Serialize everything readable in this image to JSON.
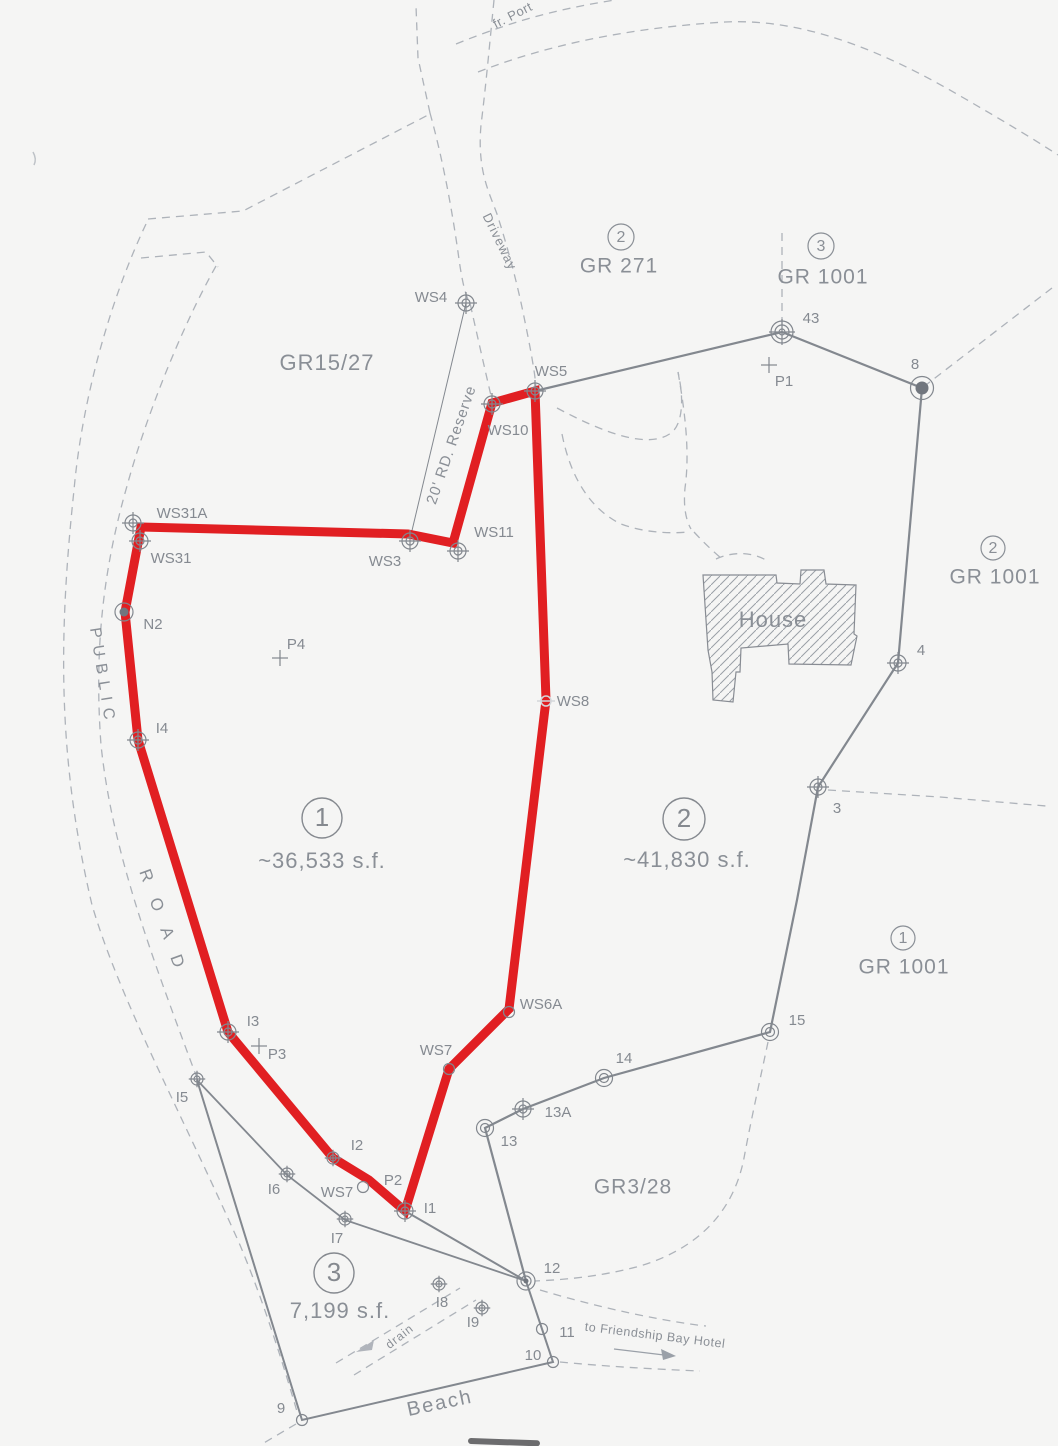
{
  "map": {
    "grant_labels": [
      {
        "text": "GR15/27",
        "x": 327,
        "y": 364,
        "size": 22
      },
      {
        "text": "GR 271",
        "x": 619,
        "y": 267,
        "size": 21,
        "badge": "2",
        "bx": 621,
        "by": 237,
        "br": 13
      },
      {
        "text": "GR 1001",
        "x": 823,
        "y": 278,
        "size": 21,
        "badge": "3",
        "bx": 821,
        "by": 246,
        "br": 13
      },
      {
        "text": "GR 1001",
        "x": 995,
        "y": 578,
        "size": 21,
        "badge": "2",
        "bx": 993,
        "by": 548,
        "br": 12
      },
      {
        "text": "GR 1001",
        "x": 904,
        "y": 968,
        "size": 21,
        "badge": "1",
        "bx": 903,
        "by": 938,
        "br": 12
      },
      {
        "text": "GR3/28",
        "x": 633,
        "y": 1188,
        "size": 21
      }
    ],
    "parcels": [
      {
        "number": "1",
        "area": "~36,533 s.f.",
        "cx": 322,
        "cy": 818,
        "r": 20,
        "ax": 322,
        "ay": 862
      },
      {
        "number": "2",
        "area": "~41,830 s.f.",
        "cx": 684,
        "cy": 819,
        "r": 21,
        "ax": 687,
        "ay": 861
      },
      {
        "number": "3",
        "area": "7,199 s.f.",
        "cx": 334,
        "cy": 1273,
        "r": 20,
        "ax": 340,
        "ay": 1312
      }
    ],
    "feature_labels": [
      {
        "id": "house-label",
        "text": "House",
        "x": 773,
        "y": 621,
        "size": 22,
        "rot": 0,
        "spacing": 1
      },
      {
        "id": "beach-label",
        "text": "Beach",
        "x": 440,
        "y": 1404,
        "size": 20,
        "rot": -12,
        "spacing": 2
      },
      {
        "id": "drain-label",
        "text": "drain",
        "x": 400,
        "y": 1337,
        "size": 12,
        "rot": -38,
        "spacing": 1
      },
      {
        "id": "hotel-route-label",
        "text": "to Friendship Bay Hotel",
        "x": 655,
        "y": 1336,
        "size": 12.5,
        "rot": 7,
        "spacing": 0.5
      },
      {
        "id": "from-port-label",
        "text": "fr. Port",
        "x": 513,
        "y": 16,
        "size": 13,
        "rot": -27,
        "spacing": 0.5
      },
      {
        "id": "road-reserve-label",
        "text": "20' RD. Reserve",
        "x": 452,
        "y": 445,
        "size": 15,
        "rot": -71,
        "spacing": 1
      },
      {
        "id": "driveway-label",
        "text": "Driveway",
        "x": 499,
        "y": 242,
        "size": 13,
        "rot": 64,
        "spacing": 1
      },
      {
        "id": "public-road-label-1",
        "text": "PUBLIC",
        "x": 102,
        "y": 677,
        "size": 16,
        "rot": 81,
        "spacing": 7
      },
      {
        "id": "public-road-label-2",
        "text": "ROAD",
        "x": 164,
        "y": 927,
        "size": 17,
        "rot": 70,
        "spacing": 18
      }
    ],
    "points": [
      {
        "label": "WS4",
        "x": 466,
        "y": 303,
        "marker": "target",
        "lx": 431,
        "ly": 298
      },
      {
        "label": "WS5",
        "x": 535,
        "y": 391,
        "marker": "target",
        "lx": 551,
        "ly": 372
      },
      {
        "label": "WS10",
        "x": 492,
        "y": 404,
        "marker": "target",
        "lx": 508,
        "ly": 431
      },
      {
        "label": "WS11",
        "x": 458,
        "y": 551,
        "marker": "target",
        "lx": 494,
        "ly": 533
      },
      {
        "label": "WS3",
        "x": 410,
        "y": 541,
        "marker": "target",
        "lx": 385,
        "ly": 562
      },
      {
        "label": "WS31A",
        "x": 133,
        "y": 523,
        "marker": "target",
        "lx": 182,
        "ly": 514
      },
      {
        "label": "WS31",
        "x": 140,
        "y": 541,
        "marker": "target",
        "lx": 171,
        "ly": 559
      },
      {
        "label": "N2",
        "x": 124,
        "y": 612,
        "marker": "dot",
        "lx": 153,
        "ly": 625
      },
      {
        "label": "P4",
        "x": 280,
        "y": 658,
        "marker": "cross",
        "lx": 296,
        "ly": 645
      },
      {
        "label": "I4",
        "x": 138,
        "y": 740,
        "marker": "target",
        "lx": 162,
        "ly": 729
      },
      {
        "label": "I3",
        "x": 228,
        "y": 1032,
        "marker": "target",
        "lx": 253,
        "ly": 1022
      },
      {
        "label": "P3",
        "x": 259,
        "y": 1046,
        "marker": "cross",
        "lx": 277,
        "ly": 1055
      },
      {
        "label": "I5",
        "x": 197,
        "y": 1079,
        "marker": "target",
        "s": 0.75,
        "lx": 182,
        "ly": 1098
      },
      {
        "label": "I6",
        "x": 287,
        "y": 1174,
        "marker": "target",
        "s": 0.75,
        "lx": 274,
        "ly": 1190
      },
      {
        "label": "I2",
        "x": 333,
        "y": 1158,
        "marker": "target",
        "s": 0.75,
        "lx": 357,
        "ly": 1146
      },
      {
        "label": "WS7",
        "x": 363,
        "y": 1187,
        "marker": "circle",
        "lx": 337,
        "ly": 1193
      },
      {
        "label": "P2",
        "x": 369,
        "y": 1180,
        "marker": "none",
        "lx": 393,
        "ly": 1181
      },
      {
        "label": "I1",
        "x": 405,
        "y": 1211,
        "marker": "target",
        "lx": 430,
        "ly": 1209
      },
      {
        "label": "I7",
        "x": 345,
        "y": 1219,
        "marker": "target",
        "s": 0.75,
        "lx": 337,
        "ly": 1239
      },
      {
        "label": "WS7",
        "x": 449,
        "y": 1069,
        "marker": "circle",
        "lx": 436,
        "ly": 1051
      },
      {
        "label": "WS6A",
        "x": 509,
        "y": 1012,
        "marker": "circle",
        "lx": 541,
        "ly": 1005
      },
      {
        "label": "WS8",
        "x": 546,
        "y": 701,
        "marker": "ws8",
        "lx": 573,
        "ly": 702
      },
      {
        "label": "43",
        "x": 782,
        "y": 332,
        "marker": "triple",
        "lx": 811,
        "ly": 319
      },
      {
        "label": "P1",
        "x": 769,
        "y": 365,
        "marker": "cross",
        "lx": 784,
        "ly": 382
      },
      {
        "label": "8",
        "x": 922,
        "y": 388,
        "marker": "bigdot",
        "lx": 915,
        "ly": 365
      },
      {
        "label": "4",
        "x": 898,
        "y": 663,
        "marker": "target",
        "lx": 921,
        "ly": 651
      },
      {
        "label": "3",
        "x": 818,
        "y": 787,
        "marker": "target",
        "lx": 837,
        "ly": 809
      },
      {
        "label": "15",
        "x": 770,
        "y": 1032,
        "marker": "double",
        "lx": 797,
        "ly": 1021
      },
      {
        "label": "14",
        "x": 604,
        "y": 1078,
        "marker": "double",
        "lx": 624,
        "ly": 1059
      },
      {
        "label": "13A",
        "x": 523,
        "y": 1109,
        "marker": "target",
        "lx": 558,
        "ly": 1113
      },
      {
        "label": "13",
        "x": 485,
        "y": 1128,
        "marker": "double",
        "lx": 509,
        "ly": 1142
      },
      {
        "label": "12",
        "x": 526,
        "y": 1281,
        "marker": "dot12",
        "lx": 552,
        "ly": 1269
      },
      {
        "label": "11",
        "x": 542,
        "y": 1329,
        "marker": "circle",
        "lx": 567,
        "ly": 1333
      },
      {
        "label": "10",
        "x": 553,
        "y": 1362,
        "marker": "circle",
        "lx": 533,
        "ly": 1356
      },
      {
        "label": "9",
        "x": 302,
        "y": 1420,
        "marker": "circle",
        "lx": 281,
        "ly": 1409
      },
      {
        "label": "I8",
        "x": 439,
        "y": 1284,
        "marker": "target",
        "s": 0.75,
        "lx": 442,
        "ly": 1303
      },
      {
        "label": "I9",
        "x": 482,
        "y": 1308,
        "marker": "target",
        "s": 0.75,
        "lx": 473,
        "ly": 1323
      }
    ]
  }
}
